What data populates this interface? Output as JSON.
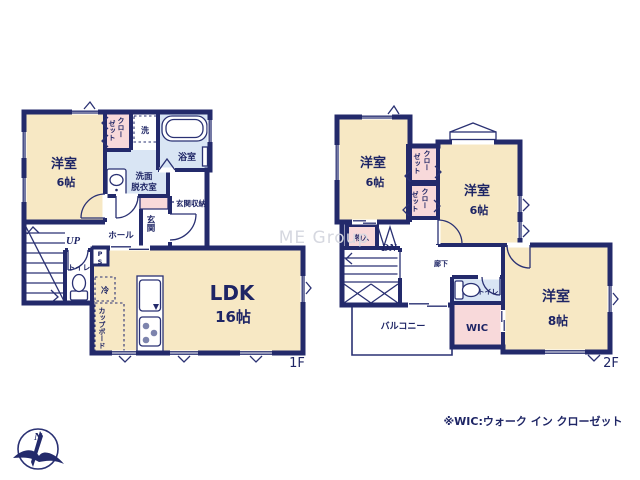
{
  "colors": {
    "wall_navy": "#232a6b",
    "text_navy": "#1e2565",
    "room_cream": "#f7e8c4",
    "closet_pink": "#f8d9da",
    "wet_area_blue": "#d9e5f4",
    "watermark_gray": "#d6d8e0",
    "background": "#ffffff"
  },
  "watermark": "ME Group",
  "note": "※WIC:ウォーク イン クローゼット",
  "compass": {
    "north": "N"
  },
  "floor1": {
    "label": "1F",
    "bedroom": {
      "name": "洋室",
      "size": "6帖"
    },
    "closet": {
      "col1": "クロー",
      "col2": "ゼット"
    },
    "washer": "洗",
    "bath": "浴室",
    "washroom": {
      "line1": "洗面",
      "line2": "脱衣室"
    },
    "entrance_storage": "玄関収納",
    "entrance": "玄関",
    "hall": "ホール",
    "up": "UP",
    "toilet": "トイレ",
    "ps": "PS",
    "fridge": "冷",
    "cupboard": "カップボード",
    "ldk": {
      "name": "LDK",
      "size": "16帖"
    }
  },
  "floor2": {
    "label": "2F",
    "bedroom1": {
      "name": "洋室",
      "size": "6帖"
    },
    "bedroom2": {
      "name": "洋室",
      "size": "6帖"
    },
    "bedroom3": {
      "name": "洋室",
      "size": "8帖"
    },
    "closet1": {
      "col1": "クロー",
      "col2": "ゼット"
    },
    "closet2": {
      "col1": "クロー",
      "col2": "ゼット"
    },
    "storage": "物入",
    "dn": "DN",
    "corridor": "廊下",
    "toilet": "トイレ",
    "wic": "WIC",
    "balcony": "バルコニー"
  }
}
